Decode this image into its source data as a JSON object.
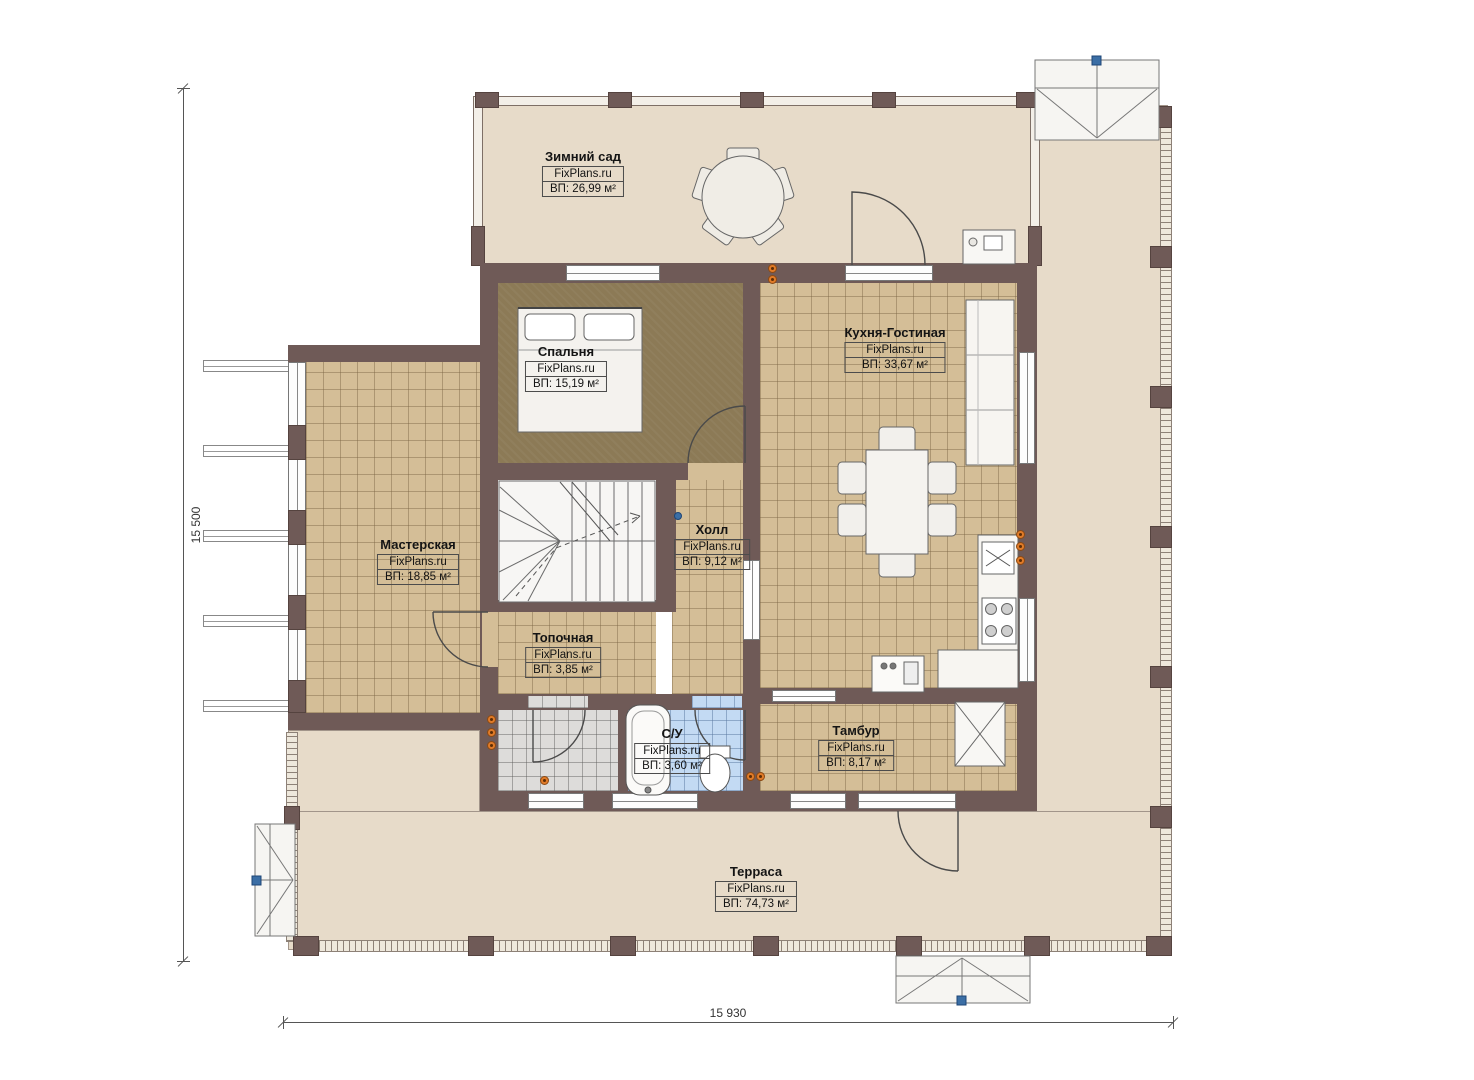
{
  "watermark": "FixPlans.ru",
  "dimensions": {
    "left_total": "15 500",
    "bottom_total": "15 930"
  },
  "rooms": [
    {
      "id": "winter-garden",
      "name": "Зимний сад",
      "area": "ВП: 26,99 м²"
    },
    {
      "id": "bedroom",
      "name": "Спальня",
      "area": "ВП: 15,19 м²"
    },
    {
      "id": "kitchen-living",
      "name": "Кухня-Гостиная",
      "area": "ВП: 33,67 м²"
    },
    {
      "id": "workshop",
      "name": "Мастерская",
      "area": "ВП: 18,85 м²"
    },
    {
      "id": "hall",
      "name": "Холл",
      "area": "ВП: 9,12 м²"
    },
    {
      "id": "boiler-room",
      "name": "Топочная",
      "area": "ВП: 3,85 м²"
    },
    {
      "id": "bathroom",
      "name": "С/У",
      "area": "ВП: 3,60 м²"
    },
    {
      "id": "vestibule",
      "name": "Тамбур",
      "area": "ВП: 8,17 м²"
    },
    {
      "id": "terrace",
      "name": "Терраса",
      "area": "ВП: 74,73 м²"
    }
  ],
  "colors": {
    "wall": "#6f5a57",
    "floor_terrace": "#e7dbc9",
    "floor_tile_tan": "#d4be97",
    "floor_bedroom": "#8c7a56",
    "floor_bathroom_blue": "#c3daf3",
    "floor_entry_gray": "#dddcda",
    "marker_orange": "#e07b28",
    "marker_blue": "#3b6ea5"
  }
}
